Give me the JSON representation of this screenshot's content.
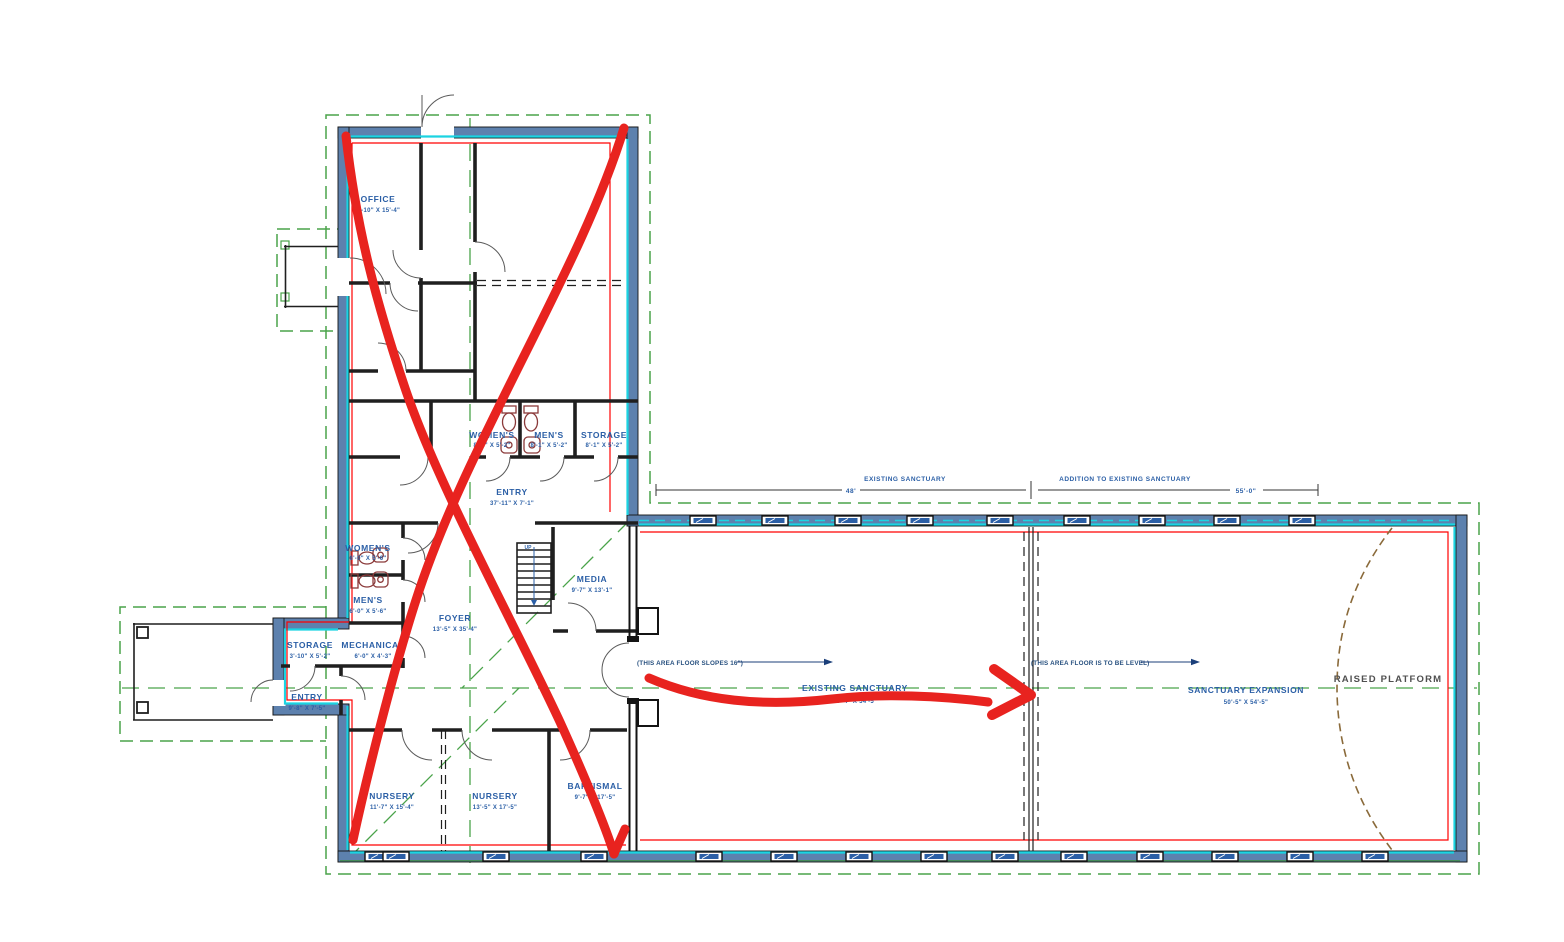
{
  "meta": {
    "title": "Church floor plan CAD drawing with red hand-drawn markup"
  },
  "colors": {
    "wall_fill": "#5d81ae",
    "cyan_wall_line": "#1bd4e2",
    "roof_green": "#4aa34a",
    "cad_red": "#ff0000",
    "text_blue": "#2b5fa6",
    "text_gray": "#4f4f4f",
    "marker_red": "#e8231f",
    "platform_brown": "#8a6a3a",
    "window_blue": "#2b5fa6"
  },
  "rooms": {
    "office": {
      "name": "OFFICE",
      "dims": "9'-10\" X 15'-4\""
    },
    "womens_top": {
      "name": "WOMEN'S",
      "dims": "8'-1\" X 5'-2\""
    },
    "mens_top": {
      "name": "MEN'S",
      "dims": "8'-1\" X 5'-2\""
    },
    "storage_top": {
      "name": "STORAGE",
      "dims": "8'-1\" X 5'-2\""
    },
    "entry_top": {
      "name": "ENTRY",
      "dims": "37'-11\" X 7'-1\""
    },
    "media": {
      "name": "MEDIA",
      "dims": "9'-7\" X 13'-1\""
    },
    "womens_left": {
      "name": "WOMEN'S",
      "dims": "6'-0\" X 5'-6\""
    },
    "mens_left": {
      "name": "MEN'S",
      "dims": "6'-0\" X 5'-6\""
    },
    "foyer": {
      "name": "FOYER",
      "dims": "13'-5\" X 35'-4\""
    },
    "storage_left": {
      "name": "STORAGE",
      "dims": "3'-10\" X 5'-2\""
    },
    "mechanical": {
      "name": "MECHANICAL",
      "dims": "6'-0\" X 4'-3\""
    },
    "entry_left": {
      "name": "ENTRY",
      "dims": "9'-8\" X 7'-5\""
    },
    "nursery_west": {
      "name": "NURSERY",
      "dims": "11'-7\" X 15'-4\""
    },
    "nursery_east": {
      "name": "NURSERY",
      "dims": "13'-5\" X 17'-5\""
    },
    "baptismal": {
      "name": "BAPTISMAL",
      "dims": "9'-7\" X 17'-5\""
    },
    "existing_sanctuary": {
      "name": "EXISTING SANCTUARY",
      "dims": "46'-4\" X 54'-5\""
    },
    "sanctuary_expansion": {
      "name": "SANCTUARY EXPANSION",
      "dims": "50'-5\" X 54'-5\""
    },
    "raised_platform": {
      "name": "RAISED PLATFORM"
    }
  },
  "stairs": {
    "label": "UP"
  },
  "notes": {
    "slope": "(THIS AREA FLOOR SLOPES 16\")",
    "level": "(THIS AREA FLOOR IS TO BE LEVEL)"
  },
  "dimensions": {
    "existing": {
      "label": "EXISTING SANCTUARY",
      "value": "48'"
    },
    "addition": {
      "label": "ADDITION TO EXISTING SANCTUARY",
      "value": "55'-0\""
    }
  }
}
